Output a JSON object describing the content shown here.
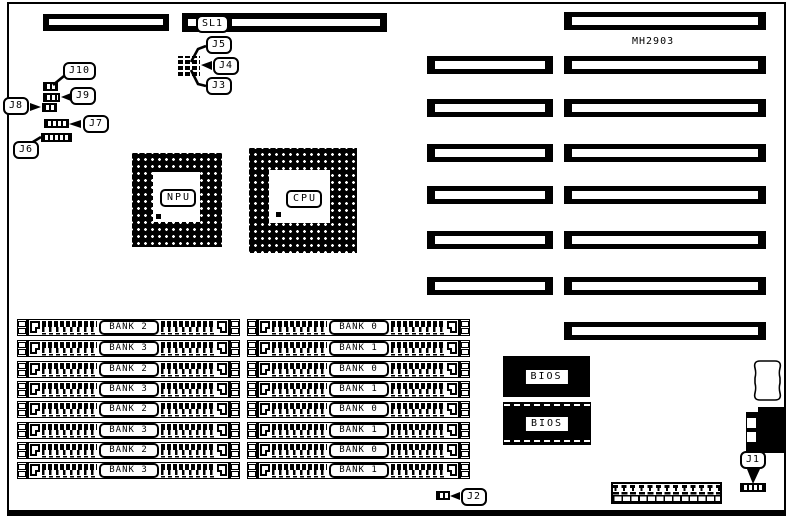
{
  "diagram": {
    "model": "MH2903",
    "colors": {
      "ink": "#000000",
      "paper": "#ffffff"
    },
    "callouts": {
      "sl1": "SL1",
      "j1": "J1",
      "j2": "J2",
      "j3": "J3",
      "j4": "J4",
      "j5": "J5",
      "j6": "J6",
      "j7": "J7",
      "j8": "J8",
      "j9": "J9",
      "j10": "J10"
    },
    "chips": {
      "npu": "NPU",
      "cpu": "CPU",
      "bios_top": "BIOS",
      "bios_bottom": "BIOS"
    },
    "simm": {
      "left_banks": [
        "BANK 2",
        "BANK 3",
        "BANK 2",
        "BANK 3",
        "BANK 2",
        "BANK 3",
        "BANK 2",
        "BANK 3"
      ],
      "right_banks": [
        "BANK 0",
        "BANK 1",
        "BANK 0",
        "BANK 1",
        "BANK 0",
        "BANK 1",
        "BANK 0",
        "BANK 1"
      ]
    }
  }
}
